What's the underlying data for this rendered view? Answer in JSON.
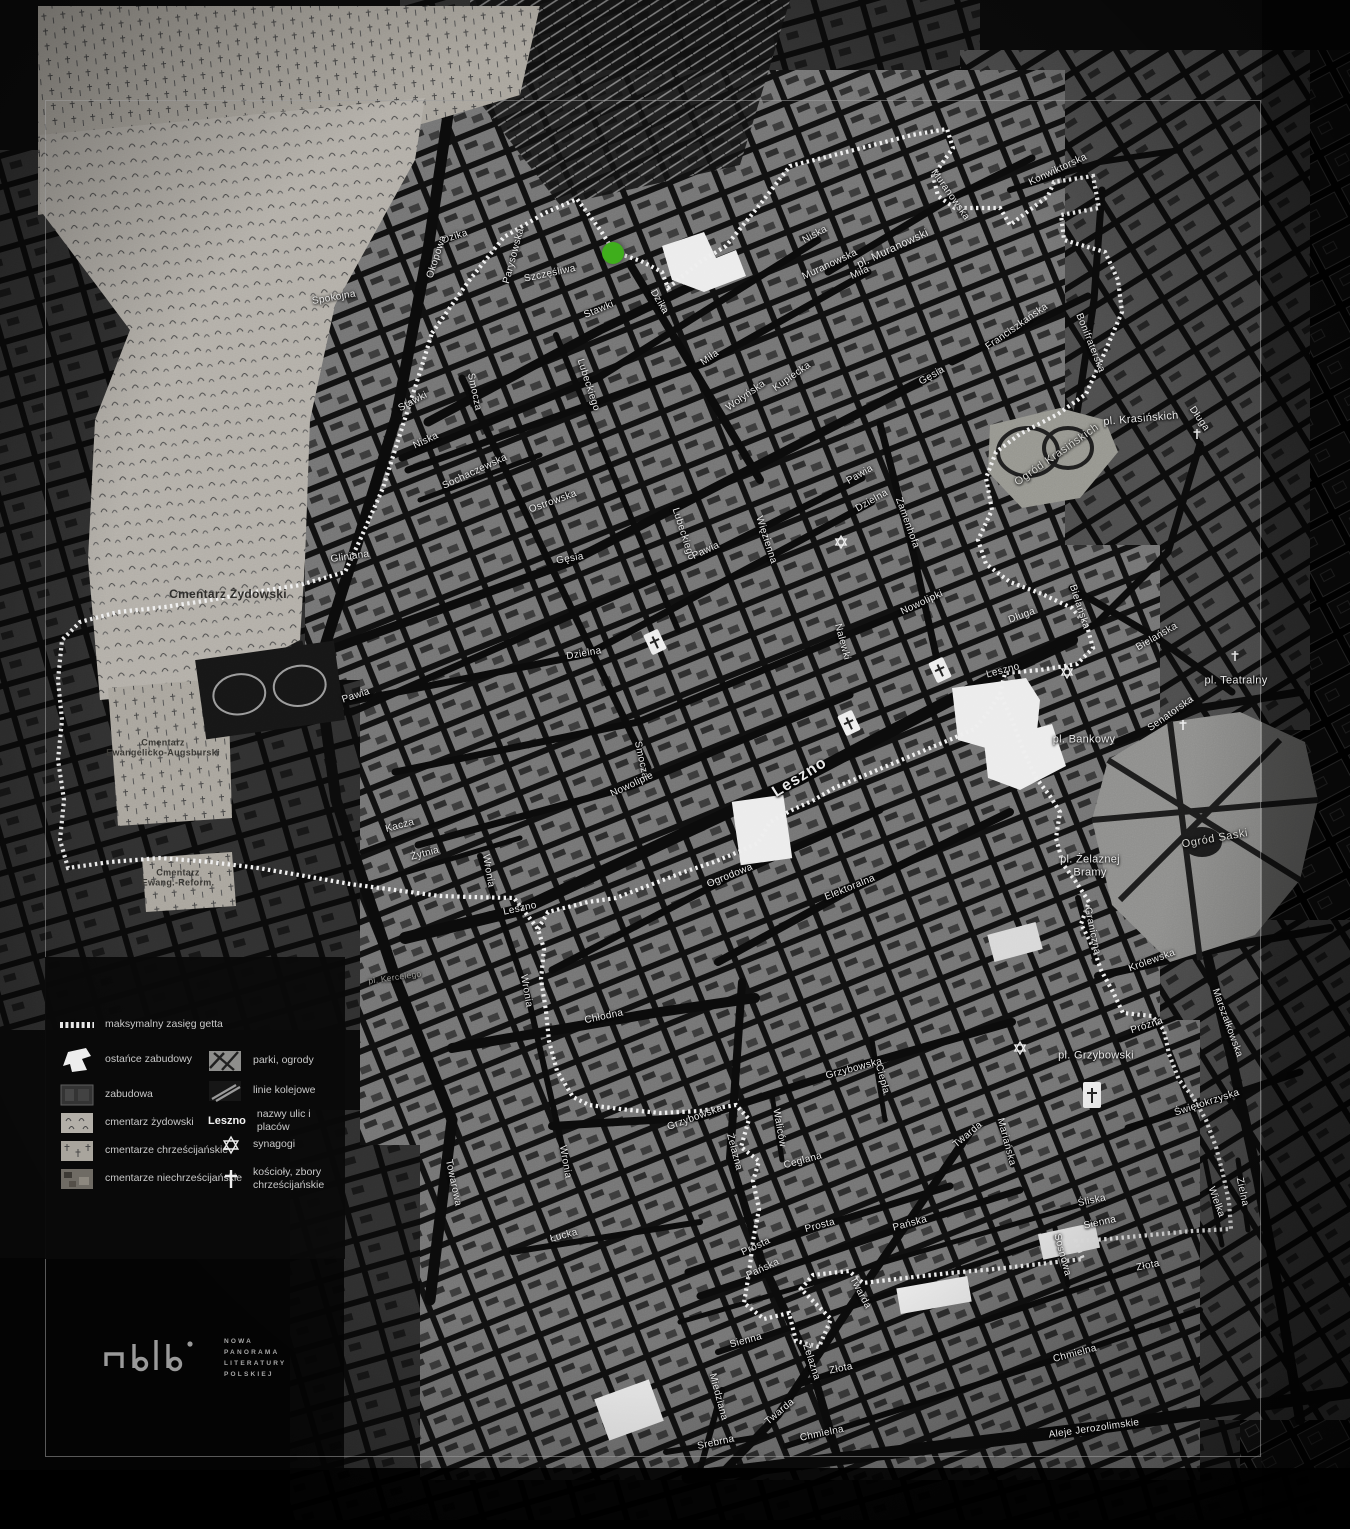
{
  "marker": {
    "x": 613,
    "y": 253,
    "color": "#3fae1c"
  },
  "colors": {
    "background": "#0a0a0a",
    "boundary": "#efefef",
    "cemetery_light": "#b3afa8",
    "park_gray": "#8e8e8c",
    "marker_green": "#3fae1c"
  },
  "legend": {
    "left": [
      {
        "icon": "ghetto-boundary-swatch",
        "label": "maksymalny zasięg getta"
      },
      {
        "icon": "surviving-buildings-swatch",
        "label": "ostańce zabudowy"
      },
      {
        "icon": "built-area-swatch",
        "label": "zabudowa"
      },
      {
        "icon": "jewish-cemetery-swatch",
        "label": "cmentarz żydowski"
      },
      {
        "icon": "christian-cemeteries-swatch",
        "label": "cmentarze chrześcijańskie"
      },
      {
        "icon": "non-christian-cemeteries-swatch",
        "label": "cmentarze niechrześcijańskie"
      }
    ],
    "right": [
      {
        "icon": "parks-swatch",
        "label": "parki, ogrody"
      },
      {
        "icon": "railways-swatch",
        "label": "linie kolejowe"
      },
      {
        "icon": "street-name-sample",
        "sample": "Leszno",
        "label": "nazwy ulic i placów"
      },
      {
        "icon": "synagogue-star-icon",
        "label": "synagogi"
      },
      {
        "icon": "church-cross-icon",
        "label": "kościoły, zbory\nchrześcijańskie"
      }
    ]
  },
  "logo": {
    "lines": [
      "NOWA",
      "PANORAMA",
      "LITERATURY",
      "POLSKIEJ"
    ]
  },
  "labels": [
    {
      "t": "Dzika",
      "x": 455,
      "y": 237,
      "r": -18
    },
    {
      "t": "Okopowa",
      "x": 437,
      "y": 257,
      "r": -72
    },
    {
      "t": "Parysowska",
      "x": 514,
      "y": 256,
      "r": -75
    },
    {
      "t": "Szczęśliwa",
      "x": 550,
      "y": 274,
      "r": -12
    },
    {
      "t": "Stawki",
      "x": 599,
      "y": 310,
      "r": -22
    },
    {
      "t": "Stawki",
      "x": 413,
      "y": 402,
      "r": -28
    },
    {
      "t": "Dzika",
      "x": 659,
      "y": 302,
      "r": 60
    },
    {
      "t": "Spokojna",
      "x": 334,
      "y": 298,
      "r": -10
    },
    {
      "t": "Gliniana",
      "x": 350,
      "y": 557,
      "r": -8
    },
    {
      "t": "Smocza",
      "x": 474,
      "y": 392,
      "r": 78
    },
    {
      "t": "Smocza",
      "x": 641,
      "y": 760,
      "r": 78
    },
    {
      "t": "Niska",
      "x": 426,
      "y": 441,
      "r": -25
    },
    {
      "t": "Niska",
      "x": 815,
      "y": 235,
      "r": -28
    },
    {
      "t": "Sochaczewska",
      "x": 475,
      "y": 472,
      "r": -25
    },
    {
      "t": "Miła",
      "x": 710,
      "y": 358,
      "r": -35
    },
    {
      "t": "Miła",
      "x": 860,
      "y": 273,
      "r": -25
    },
    {
      "t": "Wołyńska",
      "x": 746,
      "y": 396,
      "r": -35
    },
    {
      "t": "Kupiecka",
      "x": 792,
      "y": 377,
      "r": -35
    },
    {
      "t": "Gęsia",
      "x": 932,
      "y": 376,
      "r": -30
    },
    {
      "t": "Gęsia",
      "x": 570,
      "y": 559,
      "r": -10
    },
    {
      "t": "Lubeckiego",
      "x": 588,
      "y": 385,
      "r": 72
    },
    {
      "t": "Lubeckiego",
      "x": 683,
      "y": 534,
      "r": 72
    },
    {
      "t": "Ostrowska",
      "x": 553,
      "y": 502,
      "r": -20
    },
    {
      "t": "Muranowska",
      "x": 950,
      "y": 195,
      "r": 55
    },
    {
      "t": "Muranowska",
      "x": 830,
      "y": 265,
      "r": -25
    },
    {
      "t": "pl. Muranowski",
      "x": 893,
      "y": 249,
      "r": -25,
      "c": "lb-place"
    },
    {
      "t": "Konwiktorska",
      "x": 1058,
      "y": 170,
      "r": -25
    },
    {
      "t": "Bonifraterska",
      "x": 1090,
      "y": 343,
      "r": 68
    },
    {
      "t": "Franciszkańska",
      "x": 1017,
      "y": 327,
      "r": -35
    },
    {
      "t": "Nalewki",
      "x": 842,
      "y": 642,
      "r": 75
    },
    {
      "t": "Zamenhofa",
      "x": 907,
      "y": 523,
      "r": 70
    },
    {
      "t": "Dzielna",
      "x": 872,
      "y": 501,
      "r": -30
    },
    {
      "t": "Dzielna",
      "x": 584,
      "y": 654,
      "r": -10
    },
    {
      "t": "Pawia",
      "x": 860,
      "y": 475,
      "r": -30
    },
    {
      "t": "Pawia",
      "x": 706,
      "y": 551,
      "r": -25
    },
    {
      "t": "Pawia",
      "x": 356,
      "y": 696,
      "r": -18
    },
    {
      "t": "Więzienna",
      "x": 766,
      "y": 540,
      "r": 72
    },
    {
      "t": "Nowolipki",
      "x": 922,
      "y": 603,
      "r": -25
    },
    {
      "t": "Nowolipie",
      "x": 632,
      "y": 785,
      "r": -25
    },
    {
      "t": "Ogrodowa",
      "x": 730,
      "y": 876,
      "r": -22
    },
    {
      "t": "Elektoralna",
      "x": 850,
      "y": 888,
      "r": -22
    },
    {
      "t": "Leszno",
      "x": 800,
      "y": 778,
      "r": -32,
      "c": "lb-lg"
    },
    {
      "t": "Leszno",
      "x": 1003,
      "y": 671,
      "r": -15
    },
    {
      "t": "Leszno",
      "x": 520,
      "y": 909,
      "r": -12
    },
    {
      "t": "Długa",
      "x": 1199,
      "y": 419,
      "r": 55
    },
    {
      "t": "Długa",
      "x": 1022,
      "y": 616,
      "r": -20
    },
    {
      "t": "pl. Krasińskich",
      "x": 1141,
      "y": 419,
      "r": -5,
      "c": "lb-place"
    },
    {
      "t": "Ogród Krasińskich",
      "x": 1057,
      "y": 455,
      "r": -35,
      "c": "lb-gray"
    },
    {
      "t": "Bielańska",
      "x": 1157,
      "y": 637,
      "r": -30
    },
    {
      "t": "Bielańska",
      "x": 1079,
      "y": 607,
      "r": 72
    },
    {
      "t": "pl. Teatralny",
      "x": 1236,
      "y": 681,
      "r": 0,
      "c": "lb-place"
    },
    {
      "t": "Senatorska",
      "x": 1171,
      "y": 714,
      "r": -35
    },
    {
      "t": "pl. Bankowy",
      "x": 1084,
      "y": 740,
      "r": 0,
      "c": "lb-place"
    },
    {
      "t": "Ogród Saski",
      "x": 1215,
      "y": 839,
      "r": -10,
      "c": "lb-gray"
    },
    {
      "t": "pl. Żelaznej\nBramy",
      "x": 1090,
      "y": 866,
      "r": 0,
      "c": "lb-place"
    },
    {
      "t": "Graniczna",
      "x": 1092,
      "y": 931,
      "r": 78
    },
    {
      "t": "Królewska",
      "x": 1152,
      "y": 961,
      "r": -20
    },
    {
      "t": "Żelazna",
      "x": 734,
      "y": 1152,
      "r": 75
    },
    {
      "t": "Żelazna",
      "x": 811,
      "y": 1362,
      "r": 72
    },
    {
      "t": "Chłodna",
      "x": 604,
      "y": 1017,
      "r": -12
    },
    {
      "t": "Grzybowska",
      "x": 695,
      "y": 1118,
      "r": -20
    },
    {
      "t": "Grzybowska",
      "x": 854,
      "y": 1069,
      "r": -15
    },
    {
      "t": "Ciepła",
      "x": 882,
      "y": 1079,
      "r": 75
    },
    {
      "t": "Waliców",
      "x": 779,
      "y": 1128,
      "r": 80
    },
    {
      "t": "Ceglana",
      "x": 803,
      "y": 1161,
      "r": -15
    },
    {
      "t": "Prosta",
      "x": 820,
      "y": 1226,
      "r": -15
    },
    {
      "t": "Prosta",
      "x": 756,
      "y": 1247,
      "r": -25
    },
    {
      "t": "Pańska",
      "x": 910,
      "y": 1224,
      "r": -15
    },
    {
      "t": "Pańska",
      "x": 763,
      "y": 1269,
      "r": -25
    },
    {
      "t": "Łucka",
      "x": 564,
      "y": 1236,
      "r": -15
    },
    {
      "t": "Wronia",
      "x": 565,
      "y": 1162,
      "r": 80
    },
    {
      "t": "Wronia",
      "x": 488,
      "y": 871,
      "r": 80
    },
    {
      "t": "Wronia",
      "x": 526,
      "y": 991,
      "r": 80
    },
    {
      "t": "Kacza",
      "x": 400,
      "y": 826,
      "r": -15
    },
    {
      "t": "Żytnia",
      "x": 425,
      "y": 854,
      "r": -15
    },
    {
      "t": "pl. Kercelego",
      "x": 395,
      "y": 978,
      "r": -8,
      "c": "lb-dim"
    },
    {
      "t": "Towarowa",
      "x": 453,
      "y": 1183,
      "r": 78
    },
    {
      "t": "Srebrna",
      "x": 716,
      "y": 1443,
      "r": -12
    },
    {
      "t": "Miedziana",
      "x": 718,
      "y": 1397,
      "r": 75
    },
    {
      "t": "Twarda",
      "x": 780,
      "y": 1412,
      "r": -40
    },
    {
      "t": "Twarda",
      "x": 860,
      "y": 1293,
      "r": 62
    },
    {
      "t": "Twarda",
      "x": 968,
      "y": 1135,
      "r": -40
    },
    {
      "t": "Chmielna",
      "x": 822,
      "y": 1434,
      "r": -12
    },
    {
      "t": "Chmielna",
      "x": 1075,
      "y": 1354,
      "r": -15
    },
    {
      "t": "Złota",
      "x": 841,
      "y": 1369,
      "r": -12
    },
    {
      "t": "Złota",
      "x": 1148,
      "y": 1266,
      "r": -12
    },
    {
      "t": "Aleje Jerozolimskie",
      "x": 1094,
      "y": 1429,
      "r": -8
    },
    {
      "t": "Sienna",
      "x": 746,
      "y": 1341,
      "r": -15
    },
    {
      "t": "Sienna",
      "x": 1100,
      "y": 1223,
      "r": -12
    },
    {
      "t": "Śliska",
      "x": 1092,
      "y": 1201,
      "r": -12
    },
    {
      "t": "Sosnowa",
      "x": 1062,
      "y": 1255,
      "r": 75
    },
    {
      "t": "Marszałkowska",
      "x": 1227,
      "y": 1023,
      "r": 70
    },
    {
      "t": "Świętokrzyska",
      "x": 1207,
      "y": 1103,
      "r": -18
    },
    {
      "t": "Próżna",
      "x": 1147,
      "y": 1026,
      "r": -18
    },
    {
      "t": "pl. Grzybowski",
      "x": 1096,
      "y": 1056,
      "r": 0,
      "c": "lb-place"
    },
    {
      "t": "Zielna",
      "x": 1242,
      "y": 1192,
      "r": 78
    },
    {
      "t": "Wielka",
      "x": 1216,
      "y": 1202,
      "r": 70
    },
    {
      "t": "Mariańska",
      "x": 1006,
      "y": 1142,
      "r": 75
    },
    {
      "t": "Cmentarz Żydowski",
      "x": 228,
      "y": 595,
      "r": 0,
      "c": "lb-dark"
    },
    {
      "t": "Cmentarz\nEwangelicko-Augsburski",
      "x": 163,
      "y": 748,
      "r": 0,
      "c": "lb-darksm"
    },
    {
      "t": "Cmentarz\nEwang.-Reform.",
      "x": 178,
      "y": 878,
      "r": 0,
      "c": "lb-darksm"
    }
  ]
}
